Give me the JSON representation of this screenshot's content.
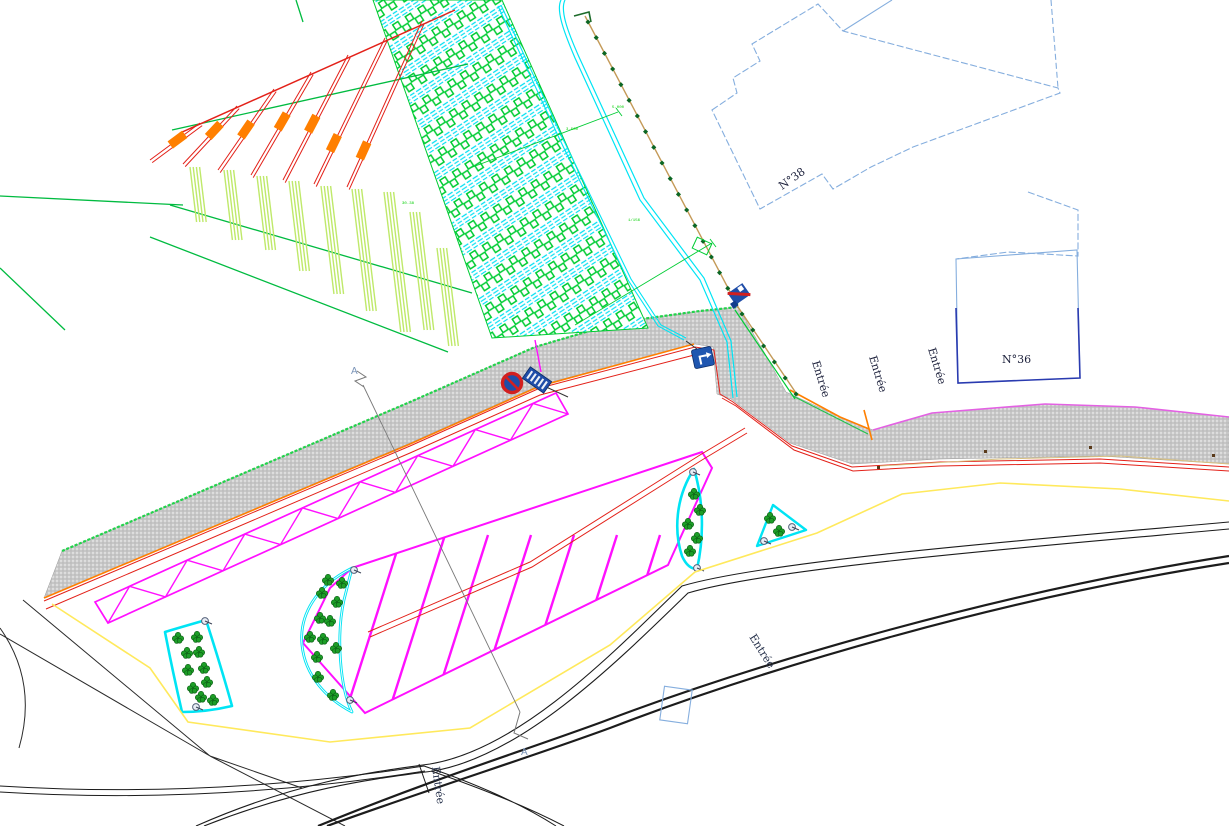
{
  "drawing": {
    "building_labels": {
      "n38": "N°38",
      "n36": "N°36"
    },
    "entrance_label": "Entrée",
    "section_marker": "A",
    "annotations": {
      "a1": "5.000",
      "a2": "3.500",
      "a3": "1/156",
      "a4": "30.38"
    },
    "signs": {
      "no_stopping": "no-stopping-sign",
      "info_placard": "blue-placard-sign",
      "crossing": "crossing-flag-sign",
      "direction_arrow": "direction-arrow-sign"
    },
    "colors": {
      "path_gray": "#c7c7c7",
      "parking_magenta": "#ff10ff",
      "bed_cyan": "#00e4f4",
      "crop_red": "#e32119",
      "marker_orange": "#ff7f00",
      "boundary_yellow": "#ffe95c",
      "field_green": "#00cc33",
      "building_blue_light": "#85aede",
      "building_blue_dark": "#2a3bb0",
      "road_black": "#1c1c1c"
    }
  }
}
